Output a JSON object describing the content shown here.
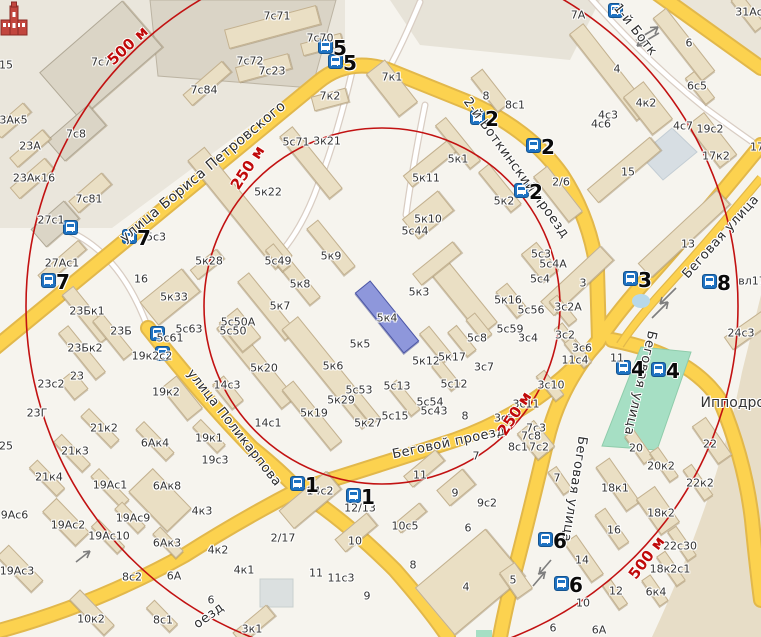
{
  "map": {
    "colors": {
      "land": "#f6f4ee",
      "building": "#eadfc4",
      "building_gray": "#dbd5c6",
      "highlight_building": "#8e97db",
      "road_yellow": "#fcd24f",
      "road_casing": "#e2b84b",
      "green_area": "#a6dfc4",
      "water": "#d7dee3",
      "ring_red": "#c21212",
      "bus_blue": "#1e72c2"
    },
    "rings": {
      "cx": 382,
      "cy": 306,
      "r250": 178,
      "r500": 356,
      "labels": [
        [
          "500 м",
          128,
          46,
          -43
        ],
        [
          "250 м",
          248,
          168,
          -57
        ],
        [
          "250 м",
          515,
          414,
          -57
        ],
        [
          "500 м",
          647,
          558,
          -53
        ]
      ]
    },
    "streets": [
      [
        "улица Бориса Петровского",
        203,
        172,
        -40,
        14
      ],
      [
        "2-й Боткинский проезд",
        516,
        168,
        54,
        13
      ],
      [
        "1-й Ботк",
        635,
        30,
        52,
        13
      ],
      [
        "Беговая улица",
        721,
        237,
        -48,
        13
      ],
      [
        "Беговая улица",
        640,
        383,
        103,
        13
      ],
      [
        "Беговая улица",
        574,
        489,
        99,
        13
      ],
      [
        "улица Поликарпова",
        234,
        428,
        52,
        13
      ],
      [
        "Беговой проезд",
        449,
        443,
        -12,
        13
      ],
      [
        "оезд",
        209,
        616,
        -36,
        13
      ]
    ],
    "bus_stops": [
      [
        326,
        47,
        "5"
      ],
      [
        336,
        62,
        "5"
      ],
      [
        616,
        11,
        ""
      ],
      [
        478,
        118,
        "2"
      ],
      [
        534,
        146,
        "2"
      ],
      [
        522,
        191,
        "2"
      ],
      [
        130,
        237,
        "7"
      ],
      [
        49,
        281,
        "7"
      ],
      [
        71,
        228,
        ""
      ],
      [
        158,
        334,
        ""
      ],
      [
        163,
        354,
        ""
      ],
      [
        631,
        279,
        "3"
      ],
      [
        710,
        282,
        "8"
      ],
      [
        624,
        368,
        "4"
      ],
      [
        659,
        370,
        "4"
      ],
      [
        298,
        484,
        "1"
      ],
      [
        354,
        496,
        "1"
      ],
      [
        546,
        540,
        "6"
      ],
      [
        562,
        584,
        "6"
      ]
    ],
    "labels": [
      [
        "7с71",
        277,
        16
      ],
      [
        "7с70",
        320,
        38
      ],
      [
        "7с72",
        250,
        61
      ],
      [
        "7с23",
        272,
        71
      ],
      [
        "7с84",
        204,
        90
      ],
      [
        "7с7",
        101,
        62
      ],
      [
        "7с8",
        76,
        134
      ],
      [
        "7с81",
        89,
        199
      ],
      [
        "23Ак5",
        10,
        120
      ],
      [
        "23А",
        30,
        146
      ],
      [
        "23Ак16",
        34,
        178
      ],
      [
        "15",
        6,
        65
      ],
      [
        "27с1",
        51,
        220
      ],
      [
        "27Ас1",
        62,
        263
      ],
      [
        "5с3",
        156,
        237
      ],
      [
        "7к2",
        330,
        96
      ],
      [
        "7к1",
        392,
        77
      ],
      [
        "8",
        486,
        96
      ],
      [
        "8с1",
        515,
        105
      ],
      [
        "7А",
        578,
        15
      ],
      [
        "31Ас",
        749,
        12
      ],
      [
        "4",
        617,
        69
      ],
      [
        "6",
        689,
        43
      ],
      [
        "6с5",
        697,
        86
      ],
      [
        "4к2",
        646,
        103
      ],
      [
        "4с3",
        608,
        115
      ],
      [
        "4с6",
        601,
        124
      ],
      [
        "4с7",
        683,
        126
      ],
      [
        "19с2",
        710,
        129
      ],
      [
        "17к2",
        716,
        156
      ],
      [
        "17",
        757,
        147
      ],
      [
        "15",
        628,
        172
      ],
      [
        "2/6",
        561,
        182
      ],
      [
        "5с71",
        296,
        142
      ],
      [
        "3к21",
        327,
        141
      ],
      [
        "5к22",
        268,
        192
      ],
      [
        "5к1",
        458,
        159
      ],
      [
        "5к11",
        426,
        178
      ],
      [
        "5к2",
        504,
        201
      ],
      [
        "5к10",
        428,
        219
      ],
      [
        "5с44",
        415,
        231
      ],
      [
        "5с49",
        278,
        261
      ],
      [
        "5к9",
        331,
        256
      ],
      [
        "5к8",
        300,
        284
      ],
      [
        "5к7",
        280,
        306
      ],
      [
        "5к3",
        419,
        292
      ],
      [
        "5к4",
        387,
        318
      ],
      [
        "5к5",
        360,
        344
      ],
      [
        "5к6",
        333,
        366
      ],
      [
        "5к20",
        264,
        368
      ],
      [
        "5с50А",
        238,
        322
      ],
      [
        "5с50",
        233,
        331
      ],
      [
        "5к28",
        209,
        261
      ],
      [
        "5к33",
        174,
        297
      ],
      [
        "16",
        141,
        279
      ],
      [
        "5с63",
        189,
        329
      ],
      [
        "5с61",
        170,
        338
      ],
      [
        "19к2с2",
        152,
        356
      ],
      [
        "19к2",
        166,
        392
      ],
      [
        "14с3",
        227,
        385
      ],
      [
        "23Бк1",
        87,
        311
      ],
      [
        "23Б",
        121,
        331
      ],
      [
        "23Бк2",
        85,
        348
      ],
      [
        "23",
        77,
        376
      ],
      [
        "23с2",
        51,
        384
      ],
      [
        "23Г",
        37,
        413
      ],
      [
        "5с53",
        359,
        390
      ],
      [
        "5к29",
        341,
        400
      ],
      [
        "5к19",
        314,
        413
      ],
      [
        "5к27",
        368,
        423
      ],
      [
        "5с15",
        395,
        416
      ],
      [
        "5с54",
        430,
        402
      ],
      [
        "5с43",
        434,
        411
      ],
      [
        "5с13",
        397,
        386
      ],
      [
        "5к12",
        426,
        361
      ],
      [
        "5к17",
        452,
        357
      ],
      [
        "5с12",
        454,
        384
      ],
      [
        "5с8",
        477,
        338
      ],
      [
        "3с7",
        484,
        367
      ],
      [
        "8",
        465,
        416
      ],
      [
        "3с8",
        504,
        418
      ],
      [
        "5к16",
        508,
        300
      ],
      [
        "5с56",
        531,
        310
      ],
      [
        "5с59",
        510,
        329
      ],
      [
        "3с4",
        528,
        338
      ],
      [
        "3с2А",
        568,
        307
      ],
      [
        "3с2",
        565,
        335
      ],
      [
        "3с6",
        582,
        348
      ],
      [
        "11с4",
        575,
        360
      ],
      [
        "11",
        617,
        358
      ],
      [
        "3с10",
        551,
        385
      ],
      [
        "3с11",
        526,
        404
      ],
      [
        "5с3",
        541,
        254
      ],
      [
        "5с4А",
        553,
        264
      ],
      [
        "5с4",
        540,
        279
      ],
      [
        "3",
        583,
        283
      ],
      [
        "13",
        688,
        244
      ],
      [
        "24с3",
        741,
        333
      ],
      [
        "вл17",
        752,
        281
      ],
      [
        "25",
        6,
        446
      ],
      [
        "21к2",
        104,
        428
      ],
      [
        "21к3",
        75,
        451
      ],
      [
        "21к4",
        49,
        477
      ],
      [
        "6Ак4",
        155,
        443
      ],
      [
        "19к1",
        209,
        438
      ],
      [
        "19с3",
        215,
        460
      ],
      [
        "19Ас1",
        110,
        485
      ],
      [
        "6Ак8",
        167,
        486
      ],
      [
        "19Ас6",
        11,
        515
      ],
      [
        "19Ас2",
        68,
        525
      ],
      [
        "19Ас9",
        133,
        518
      ],
      [
        "19Ас10",
        109,
        536
      ],
      [
        "6Ак3",
        167,
        543
      ],
      [
        "4к3",
        202,
        511
      ],
      [
        "4к2",
        218,
        550
      ],
      [
        "19Ас3",
        17,
        571
      ],
      [
        "8с2",
        132,
        577
      ],
      [
        "6А",
        174,
        576
      ],
      [
        "10к2",
        91,
        619
      ],
      [
        "8с1",
        163,
        620
      ],
      [
        "6",
        211,
        600
      ],
      [
        "3к1",
        252,
        629
      ],
      [
        "4к1",
        244,
        570
      ],
      [
        "2/17",
        283,
        538
      ],
      [
        "14с1",
        268,
        423
      ],
      [
        "14с2",
        320,
        491
      ],
      [
        "12/13",
        360,
        508
      ],
      [
        "10",
        355,
        541
      ],
      [
        "11",
        316,
        573
      ],
      [
        "11с3",
        341,
        578
      ],
      [
        "9",
        367,
        596
      ],
      [
        "10с5",
        405,
        526
      ],
      [
        "11",
        420,
        475
      ],
      [
        "9",
        455,
        493
      ],
      [
        "9с2",
        487,
        503
      ],
      [
        "6",
        468,
        528
      ],
      [
        "8",
        413,
        565
      ],
      [
        "4",
        466,
        587
      ],
      [
        "7",
        476,
        456
      ],
      [
        "7с3",
        536,
        428
      ],
      [
        "7с8",
        531,
        436
      ],
      [
        "8с1",
        518,
        447
      ],
      [
        "7с2",
        539,
        447
      ],
      [
        "7",
        557,
        478
      ],
      [
        "5",
        513,
        580
      ],
      [
        "14",
        582,
        560
      ],
      [
        "12",
        616,
        591
      ],
      [
        "10",
        583,
        603
      ],
      [
        "6",
        553,
        628
      ],
      [
        "6А",
        599,
        630
      ],
      [
        "18к1",
        615,
        488
      ],
      [
        "16",
        614,
        530
      ],
      [
        "18к2",
        661,
        513
      ],
      [
        "20",
        636,
        448
      ],
      [
        "20к2",
        661,
        466
      ],
      [
        "22",
        710,
        444
      ],
      [
        "22к2",
        700,
        483
      ],
      [
        "22с30",
        680,
        546
      ],
      [
        "18к2с1",
        670,
        569
      ],
      [
        "6к4",
        656,
        592
      ],
      [
        "Ипподром",
        738,
        403,
        14
      ]
    ],
    "buildings": [
      [
        272,
        27,
        95,
        20,
        -15
      ],
      [
        322,
        44,
        42,
        13,
        -15
      ],
      [
        263,
        68,
        55,
        16,
        -15
      ],
      [
        207,
        83,
        52,
        15,
        -41
      ],
      [
        101,
        60,
        110,
        62,
        -41,
        "g"
      ],
      [
        76,
        133,
        55,
        28,
        -41,
        "g"
      ],
      [
        90,
        193,
        44,
        16,
        -41
      ],
      [
        12,
        120,
        40,
        13,
        -41
      ],
      [
        30,
        148,
        44,
        13,
        -41
      ],
      [
        32,
        178,
        46,
        15,
        -41
      ],
      [
        55,
        224,
        44,
        24,
        -41,
        "g"
      ],
      [
        62,
        262,
        54,
        13,
        -41
      ],
      [
        330,
        99,
        36,
        15,
        -15
      ],
      [
        392,
        88,
        54,
        24,
        52
      ],
      [
        490,
        90,
        44,
        15,
        52
      ],
      [
        610,
        72,
        110,
        18,
        52
      ],
      [
        648,
        108,
        48,
        26,
        52
      ],
      [
        684,
        44,
        80,
        17,
        52
      ],
      [
        700,
        88,
        34,
        12,
        52
      ],
      [
        624,
        170,
        82,
        18,
        -40
      ],
      [
        558,
        194,
        58,
        18,
        52
      ],
      [
        712,
        140,
        54,
        22,
        52
      ],
      [
        748,
        12,
        40,
        13,
        52
      ],
      [
        684,
        234,
        108,
        20,
        -43
      ],
      [
        577,
        281,
        82,
        20,
        -43
      ],
      [
        748,
        330,
        48,
        16,
        -35
      ],
      [
        240,
        208,
        140,
        22,
        51
      ],
      [
        311,
        162,
        80,
        17,
        51
      ],
      [
        331,
        247,
        60,
        15,
        51
      ],
      [
        299,
        281,
        52,
        14,
        51
      ],
      [
        267,
        306,
        76,
        15,
        51
      ],
      [
        278,
        257,
        28,
        11,
        51
      ],
      [
        430,
        163,
        58,
        15,
        -39
      ],
      [
        458,
        143,
        56,
        14,
        51
      ],
      [
        500,
        188,
        52,
        14,
        51
      ],
      [
        428,
        215,
        46,
        26,
        -39
      ],
      [
        462,
        296,
        85,
        22,
        51
      ],
      [
        437,
        263,
        52,
        15,
        -39
      ],
      [
        387,
        317,
        78,
        20,
        51,
        "h"
      ],
      [
        330,
        372,
        128,
        21,
        51
      ],
      [
        256,
        363,
        104,
        18,
        51
      ],
      [
        312,
        415,
        78,
        15,
        51
      ],
      [
        436,
        344,
        38,
        13,
        51
      ],
      [
        462,
        341,
        32,
        12,
        51
      ],
      [
        479,
        327,
        28,
        12,
        51
      ],
      [
        446,
        375,
        32,
        12,
        51
      ],
      [
        404,
        398,
        38,
        12,
        51
      ],
      [
        365,
        408,
        34,
        12,
        51
      ],
      [
        170,
        297,
        54,
        30,
        -39
      ],
      [
        207,
        264,
        34,
        13,
        -39
      ],
      [
        87,
        314,
        62,
        15,
        51
      ],
      [
        113,
        336,
        50,
        13,
        51
      ],
      [
        82,
        352,
        60,
        13,
        51
      ],
      [
        74,
        385,
        24,
        18,
        51
      ],
      [
        240,
        330,
        38,
        24,
        51
      ],
      [
        182,
        398,
        42,
        20,
        51
      ],
      [
        228,
        392,
        32,
        15,
        51
      ],
      [
        100,
        428,
        44,
        12,
        46
      ],
      [
        72,
        453,
        42,
        12,
        46
      ],
      [
        47,
        478,
        40,
        12,
        46
      ],
      [
        155,
        441,
        44,
        12,
        46
      ],
      [
        209,
        436,
        36,
        12,
        46
      ],
      [
        160,
        500,
        56,
        34,
        46
      ],
      [
        110,
        488,
        44,
        12,
        46
      ],
      [
        66,
        522,
        48,
        20,
        46
      ],
      [
        130,
        517,
        34,
        11,
        46
      ],
      [
        108,
        536,
        38,
        11,
        46
      ],
      [
        168,
        542,
        34,
        11,
        46
      ],
      [
        20,
        568,
        50,
        17,
        46
      ],
      [
        92,
        612,
        50,
        15,
        46
      ],
      [
        162,
        616,
        34,
        12,
        46
      ],
      [
        254,
        624,
        44,
        15,
        -40
      ],
      [
        310,
        500,
        62,
        24,
        -40
      ],
      [
        356,
        532,
        42,
        17,
        -40
      ],
      [
        410,
        518,
        34,
        12,
        -40
      ],
      [
        424,
        468,
        42,
        15,
        -40
      ],
      [
        456,
        487,
        34,
        21,
        -40
      ],
      [
        470,
        582,
        92,
        62,
        -40
      ],
      [
        560,
        480,
        28,
        11,
        55
      ],
      [
        618,
        484,
        54,
        17,
        55
      ],
      [
        612,
        528,
        42,
        13,
        55
      ],
      [
        584,
        558,
        48,
        15,
        55
      ],
      [
        658,
        510,
        44,
        23,
        55
      ],
      [
        639,
        447,
        34,
        12,
        55
      ],
      [
        664,
        464,
        36,
        11,
        55
      ],
      [
        712,
        440,
        46,
        17,
        55
      ],
      [
        698,
        482,
        38,
        11,
        55
      ],
      [
        682,
        543,
        36,
        11,
        55
      ],
      [
        671,
        568,
        36,
        11,
        55
      ],
      [
        655,
        590,
        32,
        11,
        55
      ],
      [
        615,
        594,
        30,
        11,
        55
      ],
      [
        516,
        580,
        32,
        19,
        55
      ],
      [
        563,
        310,
        32,
        11,
        51
      ],
      [
        570,
        340,
        38,
        11,
        51
      ],
      [
        578,
        352,
        32,
        11,
        51
      ],
      [
        550,
        385,
        32,
        11,
        51
      ],
      [
        512,
        300,
        34,
        15,
        51
      ],
      [
        540,
        262,
        36,
        20,
        51
      ],
      [
        536,
        440,
        34,
        22,
        51
      ]
    ],
    "poi": {
      "hippodrome_label": "Ипподром"
    }
  }
}
